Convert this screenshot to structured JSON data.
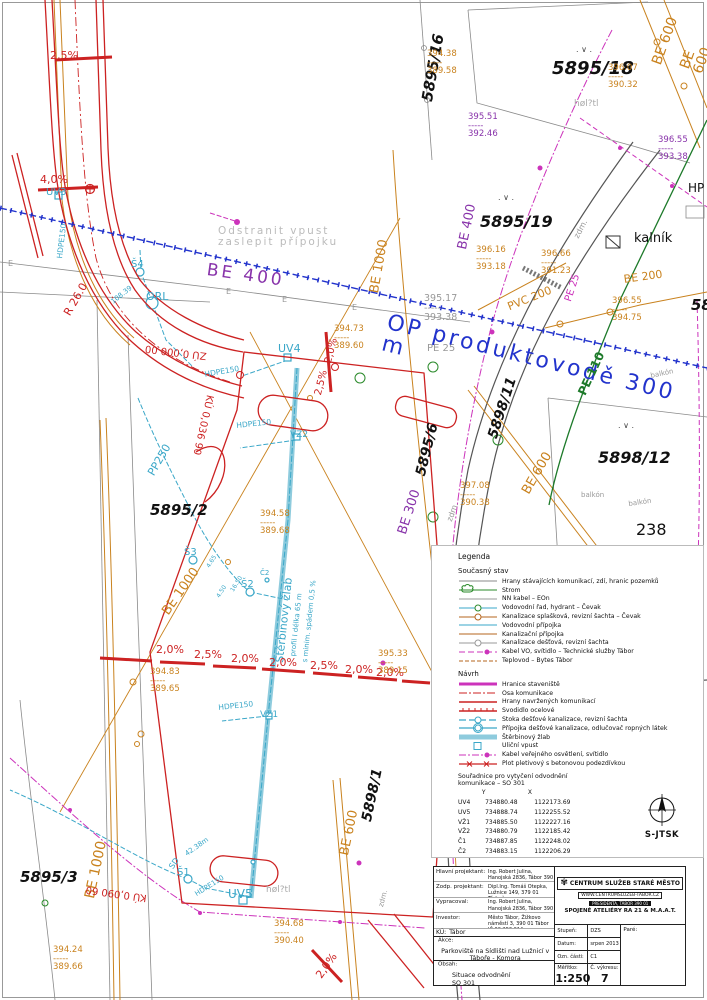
{
  "colors": {
    "road_red": "#cc2222",
    "drain_cyan": "#3aa7c8",
    "utility_orange": "#c9821e",
    "pipeline_blue": "#2233cc",
    "water_purple": "#8833aa",
    "lighting_magenta": "#cc33bb",
    "gas_green": "#1d7a2a",
    "parcel_gray": "#8a8a8a"
  },
  "north": {
    "label": "S-JTSK"
  },
  "map_labels": [
    {
      "t": "2,5%",
      "s": "left:50px;top:50px;color:#cc2222;font-size:11px"
    },
    {
      "t": "4,0%",
      "s": "left:40px;top:174px;color:#cc2222;font-size:11px"
    },
    {
      "t": "UV3",
      "s": "left:46px;top:188px;color:#3aa7c8;font-size:10px"
    },
    {
      "t": "HDPE150",
      "s": "left:56px;top:258px;color:#3aa7c8;font-size:7.5px;transform:rotate(-83deg);transform-origin:0 0"
    },
    {
      "t": "5895/16",
      "s": "left:420px;top:100px;color:#111;font-size:15px;font-weight:bold;font-style:italic;transform:rotate(-80deg);transform-origin:0 0"
    },
    {
      "t": "394.38\n-----\n389.58",
      "s": "left:427px;top:50px;color:#c9821e;font-size:8.5px"
    },
    {
      "t": "5895/18",
      "s": "left:552px;top:60px;color:#111;font-size:18px;font-weight:bold;font-style:italic"
    },
    {
      "t": "BE 600",
      "s": "left:650px;top:62px;color:#c9821e;font-size:14px;transform:rotate(-70deg);transform-origin:0 0"
    },
    {
      "t": "BE 600",
      "s": "left:678px;top:66px;color:#c9821e;font-size:14px;transform:rotate(-70deg);transform-origin:0 0"
    },
    {
      "t": "396.07\n-----\n390.32",
      "s": "left:608px;top:64px;color:#c9821e;font-size:8.5px"
    },
    {
      "t": "høl?tl",
      "s": "left:574px;top:100px;color:#aaa;font-size:9px"
    },
    {
      "t": "395.51\n-----\n392.46",
      "s": "left:468px;top:113px;color:#8833aa;font-size:8.5px"
    },
    {
      "t": "396.55\n-----\n393.38",
      "s": "left:658px;top:136px;color:#8833aa;font-size:8.5px"
    },
    {
      "t": "HP",
      "s": "left:688px;top:182px;color:#111;font-size:12px"
    },
    {
      "t": "5895/19",
      "s": "left:480px;top:214px;color:#111;font-size:16px;font-weight:bold;font-style:italic"
    },
    {
      "t": "BE 400",
      "s": "left:456px;top:248px;color:#8833aa;font-size:13px;transform:rotate(-78deg);transform-origin:0 0"
    },
    {
      "t": "Odstranit vpust\nzaslepit přípojku",
      "s": "left:218px;top:226px;color:#bbb;font-size:10.5px;letter-spacing:2px"
    },
    {
      "t": "BE 400",
      "s": "left:208px;top:262px;color:#8833aa;font-size:17px;letter-spacing:3px;transform:rotate(8deg);transform-origin:0 0"
    },
    {
      "t": "BE 1000",
      "s": "left:368px;top:292px;color:#c9821e;font-size:13px;transform:rotate(-80deg);transform-origin:0 0"
    },
    {
      "t": "Š4",
      "s": "left:131px;top:260px;color:#3aa7c8;font-size:10px"
    },
    {
      "t": "ORL",
      "s": "left:146px;top:291px;color:#3aa7c8;font-size:11px"
    },
    {
      "t": "R 26.0",
      "s": "left:62px;top:312px;color:#cc2222;font-size:11px;transform:rotate(-60deg);transform-origin:0 0"
    },
    {
      "t": "108.39",
      "s": "left:110px;top:300px;color:#3aa7c8;font-size:7px;transform:rotate(-38deg);transform-origin:0 0"
    },
    {
      "t": "394.73\n-----\n389.60",
      "s": "left:334px;top:325px;color:#c9821e;font-size:8.5px"
    },
    {
      "t": "395.17\n-----\n393.38",
      "s": "left:424px;top:294px;color:#999;font-size:9.5px"
    },
    {
      "t": "PE 25",
      "s": "left:427px;top:344px;color:#999;font-size:10px"
    },
    {
      "t": "OP produktovodě 300 m",
      "s": "left:390px;top:312px;color:#2233cc;font-size:22px;letter-spacing:3px;transform:rotate(14deg);transform-origin:0 0"
    },
    {
      "t": "396.16\n-----\n393.18",
      "s": "left:476px;top:246px;color:#c9821e;font-size:8.5px"
    },
    {
      "t": "396.66\n-----\n391.23",
      "s": "left:541px;top:250px;color:#c9821e;font-size:8.5px"
    },
    {
      "t": "kalník",
      "s": "left:634px;top:232px;color:#111;font-size:13px"
    },
    {
      "t": "zdm.",
      "s": "left:573px;top:236px;color:#999;font-size:8px;transform:rotate(-62deg);transform-origin:0 0"
    },
    {
      "t": "PVC 200",
      "s": "left:506px;top:302px;color:#c9821e;font-size:11px;transform:rotate(-22deg);transform-origin:0 0"
    },
    {
      "t": "PE 25",
      "s": "left:564px;top:300px;color:#cc33bb;font-size:10px;transform:rotate(-72deg);transform-origin:0 0"
    },
    {
      "t": "BE 200",
      "s": "left:623px;top:274px;color:#c9821e;font-size:11px;transform:rotate(-8deg);transform-origin:0 0"
    },
    {
      "t": "396.55\n-----\n394.75",
      "s": "left:612px;top:297px;color:#c9821e;font-size:8.5px"
    },
    {
      "t": "58",
      "s": "left:691px;top:298px;color:#111;font-size:15px;font-weight:bold;font-style:italic"
    },
    {
      "t": "PE 110",
      "s": "left:576px;top:392px;color:#1d7a2a;font-size:12px;font-weight:bold;transform:rotate(-65deg);transform-origin:0 0"
    },
    {
      "t": "balkón",
      "s": "left:650px;top:373px;color:#999;font-size:7px;transform:rotate(-12deg);transform-origin:0 0"
    },
    {
      "t": "5898/11",
      "s": "left:486px;top:436px;color:#111;font-size:14px;font-weight:bold;font-style:italic;transform:rotate(-72deg);transform-origin:0 0"
    },
    {
      "t": "397.08\n-----\n390.38",
      "s": "left:460px;top:482px;color:#c9821e;font-size:8.5px"
    },
    {
      "t": "BE 600",
      "s": "left:520px;top:490px;color:#c9821e;font-size:13px;transform:rotate(-60deg);transform-origin:0 0"
    },
    {
      "t": "5895/6",
      "s": "left:414px;top:474px;color:#111;font-size:14px;font-weight:bold;font-style:italic;transform:rotate(-76deg);transform-origin:0 0"
    },
    {
      "t": "BE 300",
      "s": "left:396px;top:532px;color:#8833aa;font-size:13px;transform:rotate(-72deg);transform-origin:0 0"
    },
    {
      "t": "zdm.",
      "s": "left:446px;top:520px;color:#999;font-size:8px;transform:rotate(-70deg);transform-origin:0 0"
    },
    {
      "t": "balkón",
      "s": "left:581px;top:492px;color:#999;font-size:7px"
    },
    {
      "t": "balkón",
      "s": "left:628px;top:501px;color:#999;font-size:7px;transform:rotate(-8deg);transform-origin:0 0"
    },
    {
      "t": "238",
      "s": "left:636px;top:522px;color:#111;font-size:16px"
    },
    {
      "t": "5898/12",
      "s": "left:598px;top:450px;color:#111;font-size:16px;font-weight:bold;font-style:italic"
    },
    {
      "t": ". ∨ .",
      "s": "left:576px;top:46px;color:#444;font-size:8px"
    },
    {
      "t": ". ∨ .",
      "s": "left:498px;top:194px;color:#444;font-size:8px"
    },
    {
      "t": ". ∨ .",
      "s": "left:618px;top:422px;color:#444;font-size:8px"
    },
    {
      "t": "E",
      "s": "left:226px;top:288px;color:#999;font-size:8px"
    },
    {
      "t": "E",
      "s": "left:282px;top:296px;color:#999;font-size:8px"
    },
    {
      "t": "E",
      "s": "left:352px;top:304px;color:#999;font-size:8px"
    },
    {
      "t": "E",
      "s": "left:8px;top:260px;color:#999;font-size:8px"
    },
    {
      "t": "5895/2",
      "s": "left:150px;top:503px;color:#111;font-size:15px;font-weight:bold;font-style:italic"
    },
    {
      "t": "394.58\n-----\n389.68",
      "s": "left:260px;top:510px;color:#c9821e;font-size:8.5px"
    },
    {
      "t": "UV4",
      "s": "left:278px;top:343px;color:#3aa7c8;font-size:11px"
    },
    {
      "t": "2,5%",
      "s": "left:314px;top:394px;color:#cc2222;font-size:10px;transform:rotate(-76deg);transform-origin:0 0"
    },
    {
      "t": "2,0%",
      "s": "left:324px;top:362px;color:#cc2222;font-size:10px;transform:rotate(-76deg);transform-origin:0 0"
    },
    {
      "t": "HDPE150",
      "s": "left:204px;top:371px;color:#3aa7c8;font-size:7.5px;transform:rotate(-10deg);transform-origin:0 0"
    },
    {
      "t": "HDPE150",
      "s": "left:236px;top:422px;color:#3aa7c8;font-size:7.5px;transform:rotate(-6deg);transform-origin:0 0"
    },
    {
      "t": "VZ2",
      "s": "left:290px;top:431px;color:#3aa7c8;font-size:9px"
    },
    {
      "t": "PP250",
      "s": "left:146px;top:472px;color:#3aa7c8;font-size:11px;transform:rotate(-60deg);transform-origin:0 0"
    },
    {
      "t": "ZÚ 0,000 00",
      "s": "left:206px;top:360px;color:#cc2222;font-size:10px;transform:rotate(187deg);transform-origin:0 0"
    },
    {
      "t": "KÚ 0,036 90",
      "s": "left:214px;top:396px;color:#cc2222;font-size:10px;transform:rotate(103deg);transform-origin:0 0"
    },
    {
      "t": "BE 1000",
      "s": "left:160px;top:610px;color:#c9821e;font-size:13px;transform:rotate(-55deg);transform-origin:0 0"
    },
    {
      "t": "Š3",
      "s": "left:184px;top:548px;color:#3aa7c8;font-size:10px"
    },
    {
      "t": "Š2",
      "s": "left:241px;top:580px;color:#3aa7c8;font-size:10px"
    },
    {
      "t": "Č2",
      "s": "left:260px;top:570px;color:#3aa7c8;font-size:7px"
    },
    {
      "t": "4.65",
      "s": "left:206px;top:566px;color:#3aa7c8;font-size:6px;transform:rotate(-58deg);transform-origin:0 0"
    },
    {
      "t": "16.50",
      "s": "left:230px;top:590px;color:#3aa7c8;font-size:6px;transform:rotate(-58deg);transform-origin:0 0"
    },
    {
      "t": "4.50",
      "s": "left:216px;top:596px;color:#3aa7c8;font-size:6px;transform:rotate(-58deg);transform-origin:0 0"
    },
    {
      "t": "Štěrbinový žlab",
      "s": "left:274px;top:662px;color:#3aa7c8;font-size:11px;transform:rotate(-84deg);transform-origin:0 0"
    },
    {
      "t": "profil I délka 65 m",
      "s": "left:290px;top:656px;color:#3aa7c8;font-size:7px;transform:rotate(-84deg);transform-origin:0 0"
    },
    {
      "t": "s minim. spádem 0,5 %",
      "s": "left:302px;top:662px;color:#3aa7c8;font-size:7px;transform:rotate(-84deg);transform-origin:0 0"
    },
    {
      "t": "394.83\n-----\n389.65",
      "s": "left:150px;top:668px;color:#c9821e;font-size:8.5px"
    },
    {
      "t": "2,0%",
      "s": "left:156px;top:644px;color:#cc2222;font-size:11px"
    },
    {
      "t": "2,5%",
      "s": "left:194px;top:649px;color:#cc2222;font-size:11px"
    },
    {
      "t": "2,0%",
      "s": "left:231px;top:653px;color:#cc2222;font-size:11px"
    },
    {
      "t": "2,0%",
      "s": "left:269px;top:657px;color:#cc2222;font-size:11px"
    },
    {
      "t": "2,5%",
      "s": "left:310px;top:660px;color:#cc2222;font-size:11px"
    },
    {
      "t": "2,0%",
      "s": "left:345px;top:664px;color:#cc2222;font-size:11px"
    },
    {
      "t": "2,0%",
      "s": "left:376px;top:667px;color:#cc2222;font-size:11px"
    },
    {
      "t": "HDPE150",
      "s": "left:218px;top:704px;color:#3aa7c8;font-size:7.5px;transform:rotate(-6deg);transform-origin:0 0"
    },
    {
      "t": "VZ1",
      "s": "left:260px;top:711px;color:#3aa7c8;font-size:9px"
    },
    {
      "t": "395.33\n-----\n389.15",
      "s": "left:378px;top:650px;color:#c9821e;font-size:8.5px"
    },
    {
      "t": "5898/1",
      "s": "left:360px;top:820px;color:#111;font-size:14px;font-weight:bold;font-style:italic;transform:rotate(-78deg);transform-origin:0 0"
    },
    {
      "t": "BE 600",
      "s": "left:338px;top:854px;color:#c9821e;font-size:13px;transform:rotate(-78deg);transform-origin:0 0"
    },
    {
      "t": "BE 1000",
      "s": "left:83px;top:897px;color:#c9821e;font-size:14px;transform:rotate(-78deg);transform-origin:0 0"
    },
    {
      "t": "5895/3",
      "s": "left:20px;top:870px;color:#111;font-size:15px;font-weight:bold;font-style:italic"
    },
    {
      "t": "394.24\n-----\n389.66",
      "s": "left:53px;top:946px;color:#c9821e;font-size:8.5px"
    },
    {
      "t": "KÚ 0,090 60",
      "s": "left:146px;top:902px;color:#cc2222;font-size:10px;transform:rotate(188deg);transform-origin:0 0"
    },
    {
      "t": "SD",
      "s": "left:168px;top:866px;color:#3aa7c8;font-size:8px;transform:rotate(-55deg);transform-origin:0 0"
    },
    {
      "t": "42.38m",
      "s": "left:184px;top:852px;color:#3aa7c8;font-size:7px;transform:rotate(-35deg);transform-origin:0 0"
    },
    {
      "t": "Š1",
      "s": "left:177px;top:868px;color:#3aa7c8;font-size:10px"
    },
    {
      "t": "HDPE150",
      "s": "left:194px;top:892px;color:#3aa7c8;font-size:7px;transform:rotate(-32deg);transform-origin:0 0"
    },
    {
      "t": "UV5",
      "s": "left:228px;top:888px;color:#3aa7c8;font-size:12px"
    },
    {
      "t": "høl?tl",
      "s": "left:266px;top:886px;color:#aaa;font-size:9px"
    },
    {
      "t": "394.68\n-----\n390.40",
      "s": "left:274px;top:920px;color:#c9821e;font-size:8.5px"
    },
    {
      "t": "2,0%",
      "s": "left:314px;top:974px;color:#cc2222;font-size:11px;transform:rotate(-55deg);transform-origin:0 0"
    },
    {
      "t": "zdm.",
      "s": "left:378px;top:906px;color:#999;font-size:7px;transform:rotate(-75deg);transform-origin:0 0"
    }
  ],
  "legend": {
    "title": "Legenda",
    "current_title": "Současný stav",
    "current": [
      {
        "lbl": "Hrany stávajících komunikací, zdí, hranic pozemků",
        "c": "#888",
        "w": "1"
      },
      {
        "lbl": "Strom",
        "c": "#2a8a2a",
        "w": "1",
        "trc": "#2a8a2a"
      },
      {
        "lbl": "NN kabel – EOn",
        "c": "#999",
        "w": "1"
      },
      {
        "lbl": "Vodovodní řad, hydrant – Čevak",
        "c": "#3aa7c8",
        "w": "1",
        "mr": "3",
        "mc": "#2a8a2a"
      },
      {
        "lbl": "Kanalizace splašková, revizní šachta – Čevak",
        "c": "#b5651d",
        "w": "1",
        "mr": "3",
        "mc": "#b5651d"
      },
      {
        "lbl": "Vodovodní přípojka",
        "c": "#3aa7c8",
        "w": "1"
      },
      {
        "lbl": "Kanalizační přípojka",
        "c": "#b5651d",
        "w": "1"
      },
      {
        "lbl": "Kanalizace dešťová, revizní šachta",
        "c": "#999",
        "w": "1",
        "mr": "3",
        "mc": "#999"
      },
      {
        "lbl": "Kabel VO, svítidlo – Technické služby Tábor",
        "c": "#cc33bb",
        "d": "6,3",
        "w": "1",
        "rd": "2.5",
        "mc": "#cc33bb"
      },
      {
        "lbl": "Teplovod – Bytes Tábor",
        "c": "#b5651d",
        "d": "4,2",
        "w": "1"
      }
    ],
    "proposal_title": "Návrh",
    "proposal": [
      {
        "lbl": "Hranice staveniště",
        "c": "#cc33bb",
        "w": "3"
      },
      {
        "lbl": "Osa komunikace",
        "c": "#cc2222",
        "d": "8,2,2,2",
        "w": "1"
      },
      {
        "lbl": "Hrany navržených komunikací",
        "c": "#cc2222",
        "w": "1.5"
      },
      {
        "lbl": "Svodidlo ocelové",
        "c": "#cc2222",
        "w": "1.5",
        "tc": "#cc2222"
      },
      {
        "lbl": "Stoka dešťové kanalizace, revizní šachta",
        "c": "#3aa7c8",
        "d": "7,3",
        "w": "1.2",
        "mr": "3",
        "mc": "#3aa7c8"
      },
      {
        "lbl": "Přípojka dešťové kanalizace, odlučovač ropných látek",
        "c": "#3aa7c8",
        "w": "1.2",
        "mr": "3",
        "mr2": "4.5",
        "mc": "#3aa7c8"
      },
      {
        "lbl": "Štěrbinový žlab",
        "c": "#8ecbdd",
        "w": "5"
      },
      {
        "lbl": "Uliční vpust",
        "c": "none",
        "w": "0",
        "sqw": "7",
        "sqh": "7",
        "mc": "#3aa7c8"
      },
      {
        "lbl": "Kabel veřejného osvětlení, svítidlo",
        "c": "#cc33bb",
        "d": "7,2,2,2",
        "w": "1",
        "rd": "2.5",
        "mc": "#cc33bb"
      },
      {
        "lbl": "Plot pletivový s betonovou podezdívkou",
        "c": "#cc2222",
        "w": "1.2",
        "xc": "#cc2222"
      }
    ],
    "coords": {
      "line1": "Souřadnice pro vytyčení odvodnění",
      "line2": "komunikace – SO 301",
      "col_y": "Y",
      "col_x": "X",
      "rows": [
        {
          "id": "UV4",
          "y": "734880.48",
          "x": "1122173.69"
        },
        {
          "id": "UV5",
          "y": "734888.74",
          "x": "1122255.52"
        },
        {
          "id": "VŽ1",
          "y": "734885.50",
          "x": "1122227.16"
        },
        {
          "id": "VŽ2",
          "y": "734880.79",
          "x": "1122185.42"
        },
        {
          "id": "Č1",
          "y": "734887.85",
          "x": "1122248.02"
        },
        {
          "id": "Č2",
          "y": "734883.15",
          "x": "1122206.29"
        },
        {
          "id": "ORL",
          "y": "734902.35",
          "x": "1122186.01"
        },
        {
          "id": "Š1",
          "y": "734895.05",
          "x": "1122246.78"
        },
        {
          "id": "Š2",
          "y": "734898.04",
          "x": "1122207.17"
        },
        {
          "id": "Š3",
          "y": "734895.39",
          "x": "1122201.54"
        },
        {
          "id": "Š4",
          "y": "734903.01",
          "x": "1122162.13"
        }
      ]
    },
    "abbrev": [
      "UV– uliční vpust",
      "VZ – vpusť štěrbinového žlabu",
      "Č – čisticí kus ž.žlabu",
      "ORL – odlučovač ropných látek",
      "Š – revizní šachta"
    ]
  },
  "titleblock": {
    "people": [
      {
        "label": "Hlavní projektant:",
        "value": "Ing. Robert Julina, Hanojská 2836, Tábor 390 05\nIČ 880 57 483, tel. 604 159 293"
      },
      {
        "label": "Zodp. projektant:",
        "value": "Dipl.Ing. Tomáš Otepka, Lužnice 149, 379 01 Třeboň\nČKAIT 0101045"
      },
      {
        "label": "Vypracoval:",
        "value": "Ing. Robert Julina, Hanojská 2836, Tábor 390 05\nIČ 880 57 483, tel. 604 159 293"
      },
      {
        "label": "Investor:",
        "value": "Město Tábor, Žižkovo náměstí 3, 390 01 Tábor\nIČ 00 253 014"
      }
    ],
    "ku_label": "KÚ:",
    "ku": "Tábor",
    "akce_label": "Akce:",
    "akce": "Parkoviště na Sídlišti nad Lužnicí v Táboře  - Komora",
    "obsah_label": "Obsah:",
    "obsah": "Situace odvodnění\nSO 301",
    "stamp": {
      "company": "CENTRUM SLUŽEB STARÉ MĚSTO",
      "web": "WWW.CENTRUMSLUZEB-TABOR.CZ",
      "address": "PRESIDENTA, TÁBOR 390 01",
      "studio": "SPOJENÉ ATELIÉRY RA 21 & M.A.A.T."
    },
    "fields": {
      "stupen_label": "Stupeň:",
      "stupen": "DZS",
      "datum_label": "Datum:",
      "datum": "srpen 2013",
      "ozn_label": "Ozn. části:",
      "ozn": "C1",
      "meritko_label": "Měřítko:",
      "meritko": "1:250",
      "vykres_label": "Č. výkresu:",
      "vykres": "7",
      "pare_label": "Paré:"
    }
  }
}
